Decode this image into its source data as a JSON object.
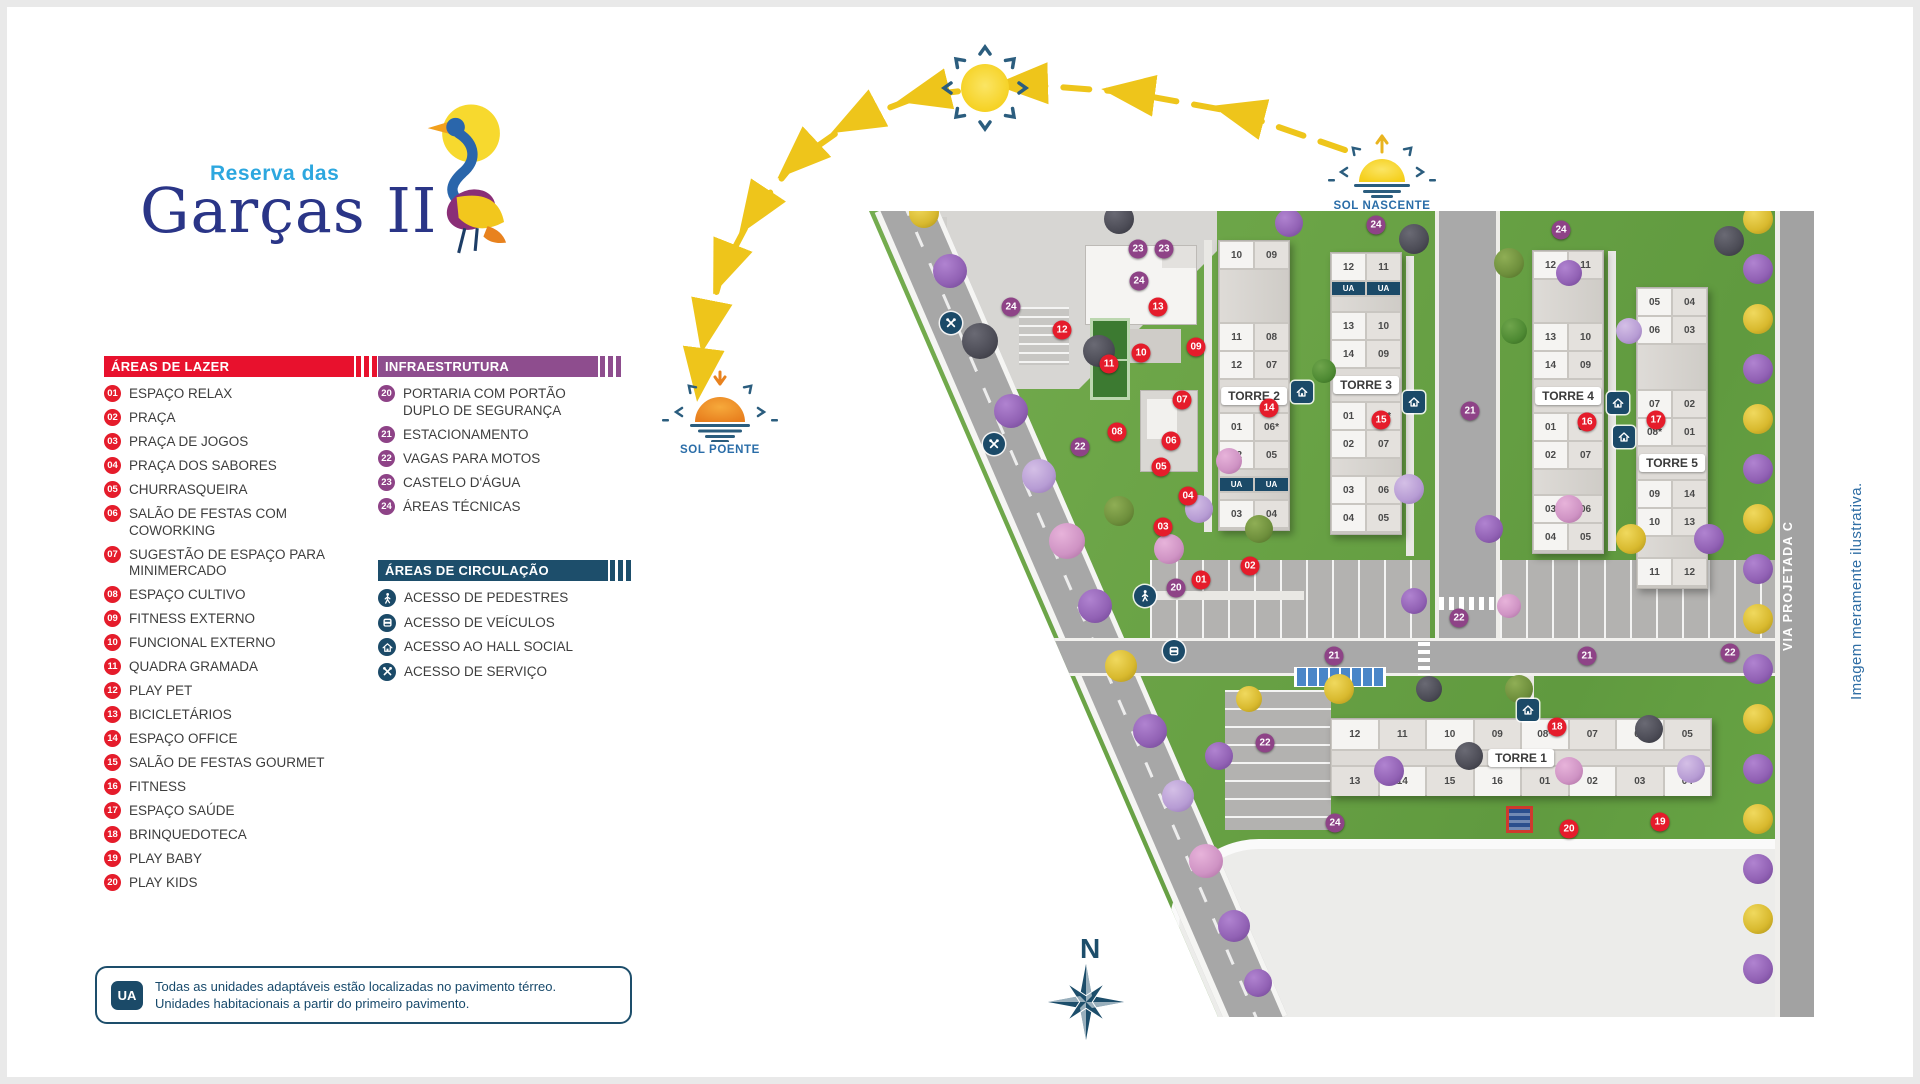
{
  "logo": {
    "tagline": "Reserva das",
    "name": "Garças II"
  },
  "legend": {
    "lazer": {
      "title": "ÁREAS DE LAZER",
      "color": "#e8112d",
      "items": [
        [
          "01",
          "ESPAÇO RELAX"
        ],
        [
          "02",
          "PRAÇA"
        ],
        [
          "03",
          "PRAÇA DE JOGOS"
        ],
        [
          "04",
          "PRAÇA DOS SABORES"
        ],
        [
          "05",
          "CHURRASQUEIRA"
        ],
        [
          "06",
          "SALÃO DE FESTAS COM COWORKING"
        ],
        [
          "07",
          "SUGESTÃO DE ESPAÇO PARA MINIMERCADO"
        ],
        [
          "08",
          "ESPAÇO CULTIVO"
        ],
        [
          "09",
          "FITNESS EXTERNO"
        ],
        [
          "10",
          "FUNCIONAL EXTERNO"
        ],
        [
          "11",
          "QUADRA GRAMADA"
        ],
        [
          "12",
          "PLAY PET"
        ],
        [
          "13",
          "BICICLETÁRIOS"
        ],
        [
          "14",
          "ESPAÇO OFFICE"
        ],
        [
          "15",
          "SALÃO DE FESTAS GOURMET"
        ],
        [
          "16",
          "FITNESS"
        ],
        [
          "17",
          "ESPAÇO SAÚDE"
        ],
        [
          "18",
          "BRINQUEDOTECA"
        ],
        [
          "19",
          "PLAY BABY"
        ],
        [
          "20",
          "PLAY KIDS"
        ]
      ]
    },
    "infra": {
      "title": "INFRAESTRUTURA",
      "color": "#8e4d8e",
      "items": [
        [
          "20",
          "PORTARIA COM PORTÃO DUPLO DE SEGURANÇA"
        ],
        [
          "21",
          "ESTACIONAMENTO"
        ],
        [
          "22",
          "VAGAS PARA MOTOS"
        ],
        [
          "23",
          "CASTELO D'ÁGUA"
        ],
        [
          "24",
          "ÁREAS TÉCNICAS"
        ]
      ]
    },
    "circ": {
      "title": "ÁREAS DE CIRCULAÇÃO",
      "color": "#1d4e6b",
      "items": [
        [
          "walk",
          "ACESSO DE PEDESTRES"
        ],
        [
          "car",
          "ACESSO DE VEÍCULOS"
        ],
        [
          "hall",
          "ACESSO AO HALL SOCIAL"
        ],
        [
          "service",
          "ACESSO DE SERVIÇO"
        ]
      ]
    }
  },
  "note": {
    "badge": "UA",
    "text1": "Todas as unidades adaptáveis estão localizadas no pavimento térreo.",
    "text2": "Unidades habitacionais a partir do primeiro pavimento."
  },
  "sun": {
    "nascente": "SOL NASCENTE",
    "poente": "SOL POENTE"
  },
  "compass": "N",
  "disclaimer": "Imagem meramente ilustrativa.",
  "map": {
    "roadA": "VIA PROJETADA A",
    "roadC": "VIA PROJETADA C",
    "towers": [
      {
        "name": "TORRE 1",
        "type": "h",
        "x": 461,
        "y": 507,
        "w": 382,
        "top": [
          "12",
          "11",
          "10",
          "09",
          "08*",
          "07",
          "06",
          "05"
        ],
        "bottom": [
          "13",
          "14",
          "15",
          "16",
          "01",
          "02",
          "03",
          "04"
        ]
      },
      {
        "name": "TORRE 2",
        "type": "v",
        "x": 349,
        "y": 29,
        "w": 72,
        "rows": [
          [
            "10",
            "09"
          ],
          52,
          [
            "11",
            "08"
          ],
          [
            "12",
            "07"
          ],
          "L",
          [
            "01",
            "06*"
          ],
          [
            "02",
            "05"
          ],
          6,
          [
            "UA",
            "UA"
          ],
          6,
          [
            "03",
            "04"
          ]
        ]
      },
      {
        "name": "TORRE 3",
        "type": "v",
        "x": 461,
        "y": 41,
        "w": 72,
        "rows": [
          [
            "12",
            "11"
          ],
          [
            "UA",
            "UA"
          ],
          14,
          [
            "13",
            "10"
          ],
          [
            "14",
            "09"
          ],
          "L",
          [
            "01",
            "08*"
          ],
          [
            "02",
            "07"
          ],
          16,
          [
            "03",
            "06"
          ],
          [
            "04",
            "05"
          ]
        ]
      },
      {
        "name": "TORRE 4",
        "type": "v",
        "x": 663,
        "y": 39,
        "w": 72,
        "rows": [
          [
            "12",
            "11"
          ],
          42,
          [
            "13",
            "10"
          ],
          [
            "14",
            "09"
          ],
          "L",
          [
            "01",
            "08*"
          ],
          [
            "02",
            "07"
          ],
          24,
          [
            "03",
            "06"
          ],
          [
            "04",
            "05"
          ]
        ]
      },
      {
        "name": "TORRE 5",
        "type": "v",
        "x": 767,
        "y": 76,
        "w": 72,
        "rows": [
          [
            "05",
            "04"
          ],
          [
            "06",
            "03"
          ],
          44,
          [
            "07",
            "02"
          ],
          [
            "08*",
            "01"
          ],
          "L",
          [
            "09",
            "14"
          ],
          [
            "10",
            "13"
          ],
          20,
          [
            "11",
            "12"
          ]
        ]
      }
    ],
    "markers": {
      "red": [
        {
          "n": "01",
          "x": 332,
          "y": 369
        },
        {
          "n": "02",
          "x": 381,
          "y": 355
        },
        {
          "n": "03",
          "x": 294,
          "y": 316
        },
        {
          "n": "04",
          "x": 319,
          "y": 285
        },
        {
          "n": "05",
          "x": 292,
          "y": 256
        },
        {
          "n": "06",
          "x": 302,
          "y": 230
        },
        {
          "n": "07",
          "x": 313,
          "y": 189
        },
        {
          "n": "08",
          "x": 248,
          "y": 221
        },
        {
          "n": "09",
          "x": 327,
          "y": 136
        },
        {
          "n": "10",
          "x": 272,
          "y": 142
        },
        {
          "n": "11",
          "x": 240,
          "y": 153
        },
        {
          "n": "12",
          "x": 193,
          "y": 119
        },
        {
          "n": "13",
          "x": 289,
          "y": 96
        },
        {
          "n": "14",
          "x": 400,
          "y": 197
        },
        {
          "n": "15",
          "x": 512,
          "y": 209
        },
        {
          "n": "16",
          "x": 718,
          "y": 211
        },
        {
          "n": "17",
          "x": 787,
          "y": 209
        },
        {
          "n": "18",
          "x": 688,
          "y": 516
        },
        {
          "n": "19",
          "x": 791,
          "y": 611
        },
        {
          "n": "20",
          "x": 700,
          "y": 618
        }
      ],
      "purple": [
        {
          "n": "20",
          "x": 307,
          "y": 377
        },
        {
          "n": "21",
          "x": 601,
          "y": 200
        },
        {
          "n": "21",
          "x": 465,
          "y": 445
        },
        {
          "n": "21",
          "x": 718,
          "y": 445
        },
        {
          "n": "22",
          "x": 211,
          "y": 236
        },
        {
          "n": "22",
          "x": 590,
          "y": 407
        },
        {
          "n": "22",
          "x": 861,
          "y": 442
        },
        {
          "n": "22",
          "x": 396,
          "y": 532
        },
        {
          "n": "23",
          "x": 269,
          "y": 38
        },
        {
          "n": "23",
          "x": 295,
          "y": 38
        },
        {
          "n": "24",
          "x": 270,
          "y": 70
        },
        {
          "n": "24",
          "x": 142,
          "y": 96
        },
        {
          "n": "24",
          "x": 507,
          "y": 14
        },
        {
          "n": "24",
          "x": 692,
          "y": 19
        },
        {
          "n": "24",
          "x": 466,
          "y": 612
        }
      ]
    },
    "access": [
      {
        "t": "service",
        "x": 82,
        "y": 112
      },
      {
        "t": "service",
        "x": 125,
        "y": 233
      },
      {
        "t": "walk",
        "x": 276,
        "y": 385
      },
      {
        "t": "car",
        "x": 305,
        "y": 440
      },
      {
        "t": "hall",
        "x": 433,
        "y": 181
      },
      {
        "t": "hall",
        "x": 545,
        "y": 191
      },
      {
        "t": "hall",
        "x": 749,
        "y": 192
      },
      {
        "t": "hall",
        "x": 755,
        "y": 226
      },
      {
        "t": "hall",
        "x": 659,
        "y": 499
      }
    ],
    "trees": [
      [
        889,
        8,
        "y",
        30
      ],
      [
        889,
        58,
        "p",
        30
      ],
      [
        889,
        108,
        "y",
        30
      ],
      [
        889,
        158,
        "p",
        30
      ],
      [
        889,
        208,
        "y",
        30
      ],
      [
        889,
        258,
        "p",
        30
      ],
      [
        889,
        308,
        "y",
        30
      ],
      [
        889,
        358,
        "p",
        30
      ],
      [
        889,
        408,
        "y",
        30
      ],
      [
        889,
        458,
        "p",
        30
      ],
      [
        889,
        508,
        "y",
        30
      ],
      [
        889,
        558,
        "p",
        30
      ],
      [
        889,
        608,
        "y",
        30
      ],
      [
        889,
        658,
        "p",
        30
      ],
      [
        889,
        708,
        "y",
        30
      ],
      [
        889,
        758,
        "p",
        30
      ],
      [
        55,
        2,
        "y",
        30
      ],
      [
        81,
        60,
        "p",
        34
      ],
      [
        111,
        130,
        "d",
        36
      ],
      [
        142,
        200,
        "p",
        34
      ],
      [
        170,
        265,
        "l",
        34
      ],
      [
        198,
        330,
        "k",
        36
      ],
      [
        226,
        395,
        "p",
        34
      ],
      [
        252,
        455,
        "y",
        32
      ],
      [
        281,
        520,
        "p",
        34
      ],
      [
        309,
        585,
        "l",
        32
      ],
      [
        337,
        650,
        "k",
        34
      ],
      [
        365,
        715,
        "p",
        32
      ],
      [
        389,
        772,
        "p",
        28
      ],
      [
        250,
        8,
        "d",
        30
      ],
      [
        420,
        12,
        "p",
        28
      ],
      [
        545,
        28,
        "d",
        30
      ],
      [
        640,
        52,
        "o",
        30
      ],
      [
        700,
        62,
        "p",
        26
      ],
      [
        230,
        140,
        "d",
        32
      ],
      [
        250,
        300,
        "o",
        30
      ],
      [
        300,
        338,
        "k",
        30
      ],
      [
        330,
        298,
        "l",
        28
      ],
      [
        360,
        250,
        "k",
        26
      ],
      [
        390,
        318,
        "o",
        28
      ],
      [
        540,
        278,
        "l",
        30
      ],
      [
        620,
        318,
        "p",
        28
      ],
      [
        700,
        298,
        "k",
        28
      ],
      [
        762,
        328,
        "y",
        30
      ],
      [
        840,
        328,
        "p",
        30
      ],
      [
        470,
        478,
        "y",
        30
      ],
      [
        380,
        488,
        "y",
        26
      ],
      [
        350,
        545,
        "p",
        28
      ],
      [
        520,
        560,
        "p",
        30
      ],
      [
        600,
        545,
        "d",
        28
      ],
      [
        650,
        478,
        "o",
        28
      ],
      [
        700,
        560,
        "k",
        28
      ],
      [
        780,
        518,
        "d",
        28
      ],
      [
        822,
        558,
        "l",
        28
      ],
      [
        560,
        478,
        "d",
        26
      ],
      [
        860,
        30,
        "d",
        30
      ],
      [
        645,
        120,
        "g",
        26
      ],
      [
        760,
        120,
        "l",
        26
      ],
      [
        455,
        160,
        "g",
        24
      ],
      [
        545,
        390,
        "p",
        26
      ],
      [
        640,
        395,
        "k",
        24
      ]
    ]
  }
}
